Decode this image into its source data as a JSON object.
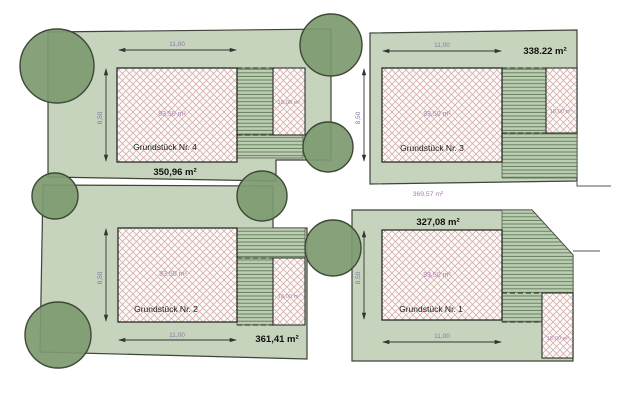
{
  "plan": {
    "type": "site-plan",
    "plots": [
      {
        "number": "Grundstück Nr. 4",
        "plot_area": "350,96 m²",
        "house_area": "93,50 m²",
        "garage_area": "18,00 m²",
        "width_dim": "11,00",
        "depth_dim": "8,50"
      },
      {
        "number": "Grundstück Nr. 3",
        "plot_area": "338.22 m²",
        "house_area": "93,50 m²",
        "garage_area": "18,00 m²",
        "width_dim": "11,00",
        "depth_dim": "8,50"
      },
      {
        "number": "Grundstück Nr. 2",
        "plot_area": "361,41 m²",
        "house_area": "93,50 m²",
        "garage_area": "18,00 m²",
        "width_dim": "11,00",
        "depth_dim": "8,50"
      },
      {
        "number": "Grundstück Nr. 1",
        "plot_area": "327,08 m²",
        "house_area": "93,50 m²",
        "garage_area": "18,00 m²",
        "width_dim": "11,00",
        "depth_dim": "8,50"
      }
    ],
    "access_area": "369,57 m²",
    "colors": {
      "plot_green": "#c6d4bd",
      "tree_green": "#7d9a70",
      "tree_outline": "#3c4a35",
      "hatch_pink": "#d4aeae",
      "stripe_green": "#5c7a52",
      "stripe_bg": "#bccdb3",
      "boundary": "#3d4438",
      "dim_purple": "#8d74ad",
      "area_purple": "#b286b2",
      "label_black": "#1a1a1a"
    }
  }
}
